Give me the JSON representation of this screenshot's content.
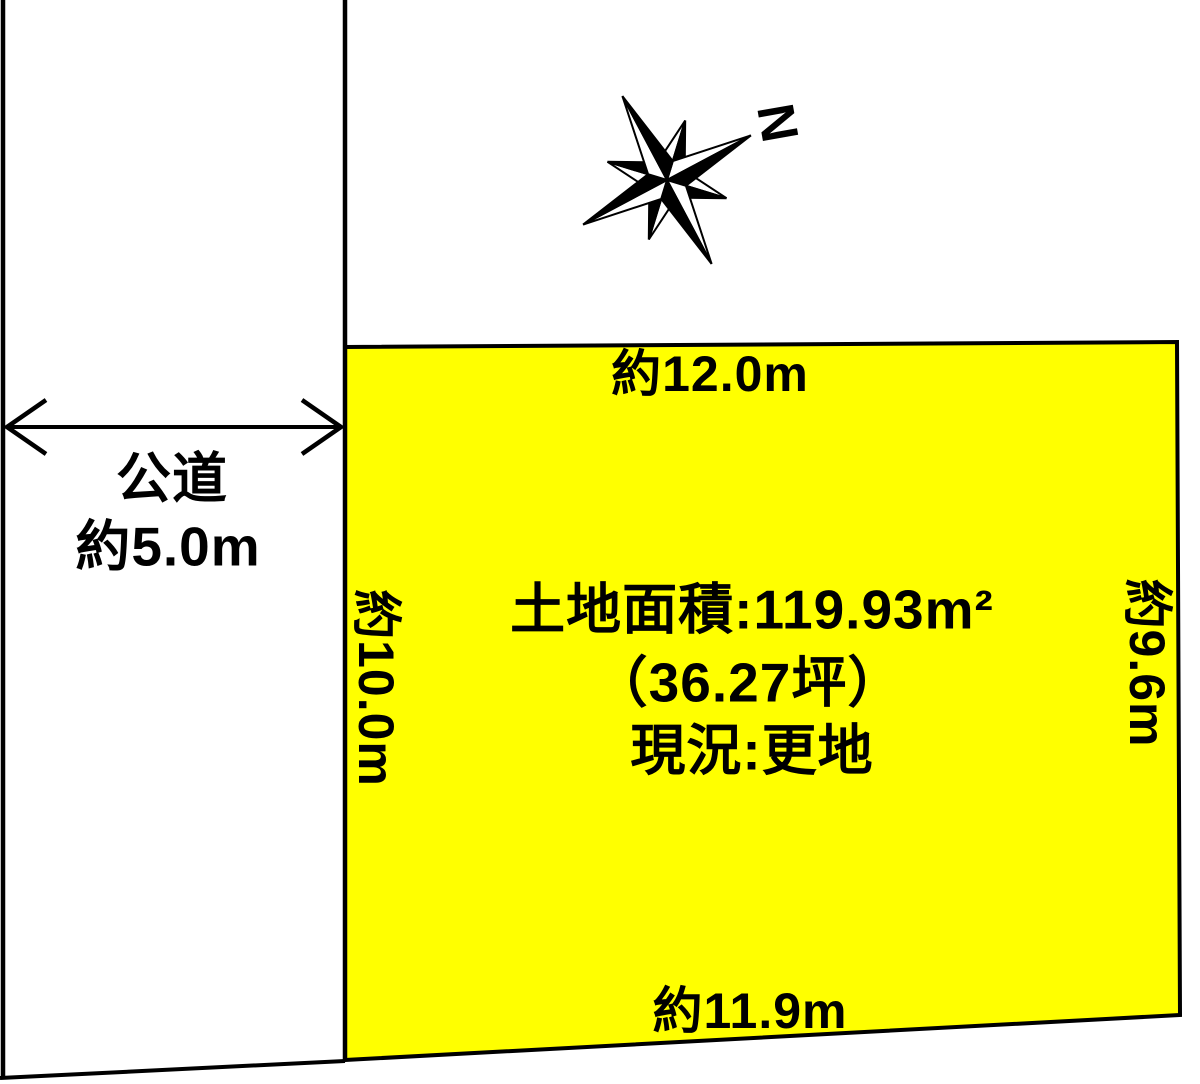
{
  "compass": {
    "north_label": "N"
  },
  "road": {
    "name": "公道",
    "width_label": "約5.0m"
  },
  "plot": {
    "fill_color": "#FFFF00",
    "border_color": "#000000",
    "top_length_label": "約12.0m",
    "bottom_length_label": "約11.9m",
    "left_length_label": "約10.0m",
    "right_length_label": "約9.6m",
    "area_label": "土地面積:119.93m²",
    "tsubo_label": "（36.27坪）",
    "status_label": "現況:更地"
  }
}
